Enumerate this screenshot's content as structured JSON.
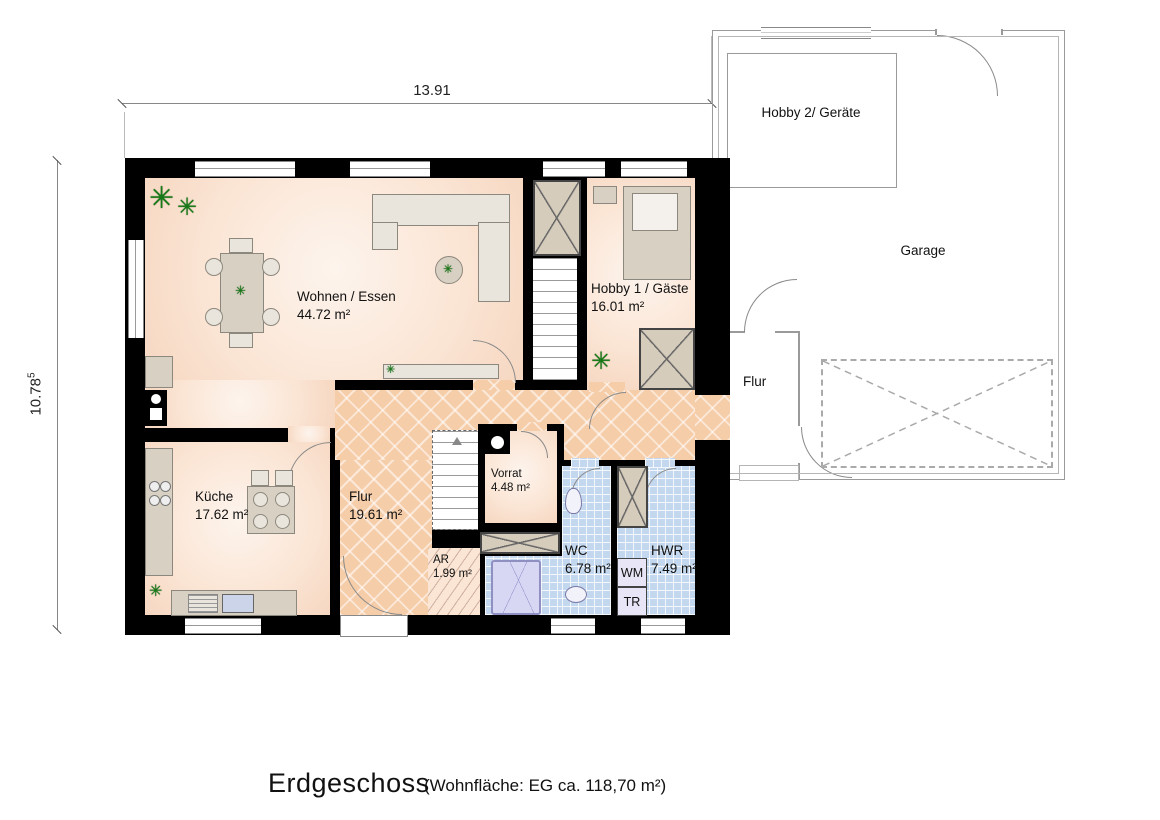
{
  "dimensions": {
    "width_label": "13.91",
    "height_label": "10.78",
    "height_sup": "5"
  },
  "rooms": {
    "wohnen": {
      "name": "Wohnen / Essen",
      "area": "44.72 m²"
    },
    "hobby1": {
      "name": "Hobby 1 / Gäste",
      "area": "16.01 m²"
    },
    "kueche": {
      "name": "Küche",
      "area": "17.62 m²"
    },
    "flur": {
      "name": "Flur",
      "area": "19.61 m²"
    },
    "vorrat": {
      "name": "Vorrat",
      "area": "4.48 m²"
    },
    "ar": {
      "name": "AR",
      "area": "1.99 m²"
    },
    "wc": {
      "name": "WC",
      "area": "6.78 m²"
    },
    "hwr": {
      "name": "HWR",
      "area": "7.49 m²"
    }
  },
  "appliances": {
    "wm": "WM",
    "tr": "TR"
  },
  "garage": {
    "hobby2": "Hobby 2/ Geräte",
    "garage": "Garage",
    "flur": "Flur"
  },
  "title": {
    "main": "Erdgeschoss",
    "sub": "(Wohnfläche: EG  ca. 118,70 m²)"
  },
  "icons": {
    "plant": "✳"
  },
  "colors": {
    "wall": "#000000",
    "floor_peach": "#fbe6d6",
    "flur_hatch": "#f6cda9",
    "tile_blue": "#c3d8ee",
    "garage_line": "#9a9a9a",
    "plant_green": "#157a15"
  }
}
